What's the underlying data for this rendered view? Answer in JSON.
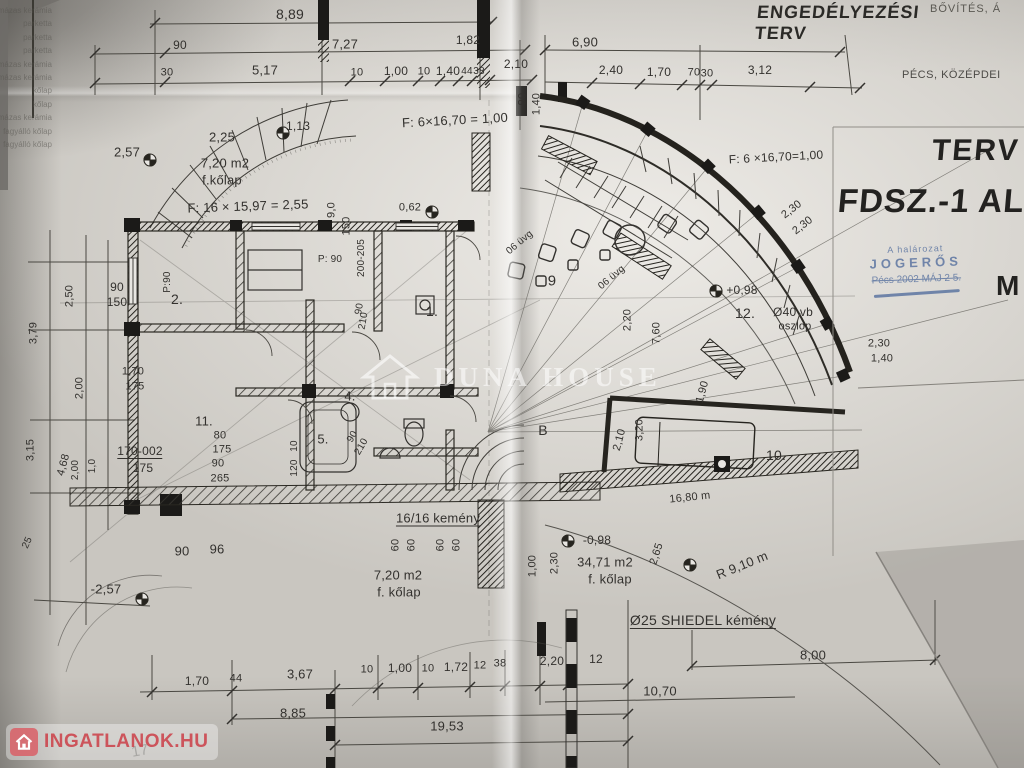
{
  "titles": {
    "plan_type": "ENGEDÉLYEZÉSI\nTERV",
    "top_right_note": "BŐVÍTÉS, Á",
    "location_note": "PÉCS, KÖZÉPDEI",
    "sheet_title_top": "TERV",
    "sheet_title_main": "FDSZ.-1 ALA",
    "scale_letter": "M"
  },
  "stamp": {
    "line1": "A halározat",
    "line2": "JOGERŐS",
    "line3": "Pécs 2002 MÁJ 2 5."
  },
  "watermark_center": {
    "text": "DUNA HOUSE"
  },
  "watermark_corner": {
    "text": "INGATLANOK.HU"
  },
  "legend_column": [
    "mázas kerámia",
    "parketta",
    "parketta",
    "parketta",
    "mázas kerámia",
    "mázas kerámia",
    "kőlap",
    "kőlap",
    "mázas kerámia",
    "fagyálló kőlap",
    "fagyálló kőlap"
  ],
  "colors": {
    "paper": "#c9c6c0",
    "ink": "#33312e",
    "stamp_blue": "#6179a3",
    "watermark_red": "#cb3e46",
    "watermark_white": "rgba(255,255,255,0.55)"
  },
  "annotations": [
    {
      "t": "8,89",
      "x": 290,
      "y": 14,
      "s": 14
    },
    {
      "t": "90",
      "x": 180,
      "y": 45,
      "s": 12
    },
    {
      "t": "7,27",
      "x": 345,
      "y": 44,
      "s": 13
    },
    {
      "t": "1,82",
      "x": 468,
      "y": 40,
      "s": 12
    },
    {
      "t": "6,90",
      "x": 585,
      "y": 42,
      "s": 13
    },
    {
      "t": "30",
      "x": 167,
      "y": 73,
      "s": 11
    },
    {
      "t": "5,17",
      "x": 265,
      "y": 70,
      "s": 13
    },
    {
      "t": "10",
      "x": 357,
      "y": 73,
      "s": 11
    },
    {
      "t": "1,00",
      "x": 396,
      "y": 71,
      "s": 12
    },
    {
      "t": "10",
      "x": 424,
      "y": 72,
      "s": 11
    },
    {
      "t": "1,40",
      "x": 448,
      "y": 71,
      "s": 12
    },
    {
      "t": "44",
      "x": 467,
      "y": 72,
      "s": 10
    },
    {
      "t": "38",
      "x": 479,
      "y": 72,
      "s": 10
    },
    {
      "t": "2,10",
      "x": 516,
      "y": 64,
      "s": 12
    },
    {
      "t": "2,40",
      "x": 611,
      "y": 70,
      "s": 12
    },
    {
      "t": "1,70",
      "x": 659,
      "y": 72,
      "s": 12
    },
    {
      "t": "70",
      "x": 694,
      "y": 73,
      "s": 11
    },
    {
      "t": "30",
      "x": 707,
      "y": 74,
      "s": 11
    },
    {
      "t": "3,12",
      "x": 760,
      "y": 70,
      "s": 12
    },
    {
      "t": "90",
      "x": 523,
      "y": 99,
      "s": 11,
      "r": -90
    },
    {
      "t": "1,40",
      "x": 537,
      "y": 104,
      "s": 11,
      "r": -90
    },
    {
      "t": "F: 6×16,70 = 1,00",
      "x": 455,
      "y": 120,
      "s": 13,
      "r": -3
    },
    {
      "t": "-1,13",
      "x": 296,
      "y": 126,
      "s": 12
    },
    {
      "t": "2,25",
      "x": 222,
      "y": 137,
      "s": 13
    },
    {
      "t": "2,57",
      "x": 127,
      "y": 152,
      "s": 13
    },
    {
      "t": "7,20 m2",
      "x": 225,
      "y": 163,
      "s": 13
    },
    {
      "t": "f.kőlap",
      "x": 222,
      "y": 180,
      "s": 13
    },
    {
      "t": "F: 16 × 15,97 = 2,55",
      "x": 248,
      "y": 206,
      "s": 13,
      "r": -2
    },
    {
      "t": "F: 6 ×16,70=1,00",
      "x": 776,
      "y": 157,
      "s": 12,
      "r": -3
    },
    {
      "t": "2,30",
      "x": 792,
      "y": 210,
      "s": 11,
      "r": -38
    },
    {
      "t": "2,30",
      "x": 803,
      "y": 226,
      "s": 11,
      "r": -38
    },
    {
      "t": "06 üvg",
      "x": 520,
      "y": 243,
      "s": 10,
      "r": -40
    },
    {
      "t": "06 üvg",
      "x": 612,
      "y": 278,
      "s": 10,
      "r": -40
    },
    {
      "t": "9",
      "x": 552,
      "y": 281,
      "s": 15
    },
    {
      "t": "+0,98",
      "x": 742,
      "y": 290,
      "s": 12
    },
    {
      "t": "12.",
      "x": 745,
      "y": 313,
      "s": 14
    },
    {
      "t": "Ø40 vb",
      "x": 793,
      "y": 312,
      "s": 12
    },
    {
      "t": "oszlop",
      "x": 795,
      "y": 327,
      "s": 11
    },
    {
      "t": "2,30",
      "x": 879,
      "y": 344,
      "s": 11
    },
    {
      "t": "1,40",
      "x": 882,
      "y": 359,
      "s": 11
    },
    {
      "t": "2,20",
      "x": 628,
      "y": 320,
      "s": 11,
      "r": -90
    },
    {
      "t": "7,60",
      "x": 657,
      "y": 333,
      "s": 11,
      "r": -90
    },
    {
      "t": "1,90",
      "x": 703,
      "y": 392,
      "s": 11,
      "r": -75
    },
    {
      "t": "3,20",
      "x": 640,
      "y": 430,
      "s": 11,
      "r": -90
    },
    {
      "t": "2,10",
      "x": 620,
      "y": 440,
      "s": 11,
      "r": -75
    },
    {
      "t": "10.",
      "x": 776,
      "y": 455,
      "s": 14
    },
    {
      "t": "B",
      "x": 543,
      "y": 430,
      "s": 14
    },
    {
      "t": "90",
      "x": 117,
      "y": 287,
      "s": 12
    },
    {
      "t": "150",
      "x": 117,
      "y": 302,
      "s": 12
    },
    {
      "t": "2,50",
      "x": 70,
      "y": 296,
      "s": 11,
      "r": -90
    },
    {
      "t": "3,79",
      "x": 34,
      "y": 333,
      "s": 11,
      "r": -90
    },
    {
      "t": "9,0",
      "x": 332,
      "y": 210,
      "s": 11,
      "r": -90
    },
    {
      "t": "150",
      "x": 347,
      "y": 226,
      "s": 11,
      "r": -90
    },
    {
      "t": "200-205",
      "x": 362,
      "y": 258,
      "s": 10,
      "r": -90
    },
    {
      "t": "0,62",
      "x": 410,
      "y": 208,
      "s": 11
    },
    {
      "t": "P: 90",
      "x": 330,
      "y": 260,
      "s": 10
    },
    {
      "t": "P:90",
      "x": 168,
      "y": 282,
      "s": 10,
      "r": -90
    },
    {
      "t": "2.",
      "x": 177,
      "y": 299,
      "s": 14
    },
    {
      "t": "1.",
      "x": 432,
      "y": 311,
      "s": 14
    },
    {
      "t": "90",
      "x": 360,
      "y": 309,
      "s": 10,
      "r": -80
    },
    {
      "t": "210",
      "x": 364,
      "y": 321,
      "s": 10,
      "r": -80
    },
    {
      "t": "1,70",
      "x": 133,
      "y": 372,
      "s": 11
    },
    {
      "t": "175",
      "x": 135,
      "y": 387,
      "s": 11
    },
    {
      "t": "2,00",
      "x": 80,
      "y": 388,
      "s": 11,
      "r": -90
    },
    {
      "t": "11.",
      "x": 204,
      "y": 421,
      "s": 13
    },
    {
      "t": "80",
      "x": 220,
      "y": 436,
      "s": 11
    },
    {
      "t": "175",
      "x": 222,
      "y": 450,
      "s": 11
    },
    {
      "t": "90",
      "x": 218,
      "y": 464,
      "s": 11
    },
    {
      "t": "265",
      "x": 220,
      "y": 479,
      "s": 11
    },
    {
      "t": "10",
      "x": 295,
      "y": 446,
      "s": 10,
      "r": -90
    },
    {
      "t": "120",
      "x": 295,
      "y": 468,
      "s": 10,
      "r": -90
    },
    {
      "t": "5.",
      "x": 323,
      "y": 439,
      "s": 13
    },
    {
      "t": "4.",
      "x": 350,
      "y": 396,
      "s": 13
    },
    {
      "t": "90",
      "x": 353,
      "y": 437,
      "s": 10,
      "r": -60
    },
    {
      "t": "210",
      "x": 362,
      "y": 447,
      "s": 10,
      "r": -60
    },
    {
      "t": "170-002",
      "x": 140,
      "y": 452,
      "s": 12,
      "c": "u"
    },
    {
      "t": "175",
      "x": 143,
      "y": 468,
      "s": 12
    },
    {
      "t": "3,15",
      "x": 31,
      "y": 450,
      "s": 11,
      "r": -90
    },
    {
      "t": "4,68",
      "x": 64,
      "y": 465,
      "s": 11,
      "r": -75
    },
    {
      "t": "2,00",
      "x": 76,
      "y": 470,
      "s": 10,
      "r": -90
    },
    {
      "t": "1,0",
      "x": 93,
      "y": 466,
      "s": 10,
      "r": -90
    },
    {
      "t": "25",
      "x": 28,
      "y": 543,
      "s": 10,
      "r": -65
    },
    {
      "t": "90",
      "x": 182,
      "y": 551,
      "s": 13
    },
    {
      "t": "96",
      "x": 217,
      "y": 549,
      "s": 13
    },
    {
      "t": "-2,57",
      "x": 106,
      "y": 589,
      "s": 13
    },
    {
      "t": "16/16 kemény",
      "x": 438,
      "y": 519,
      "s": 13,
      "c": "u"
    },
    {
      "t": "60",
      "x": 396,
      "y": 545,
      "s": 11,
      "r": -90
    },
    {
      "t": "60",
      "x": 412,
      "y": 545,
      "s": 11,
      "r": -90
    },
    {
      "t": "60",
      "x": 441,
      "y": 545,
      "s": 11,
      "r": -90
    },
    {
      "t": "60",
      "x": 457,
      "y": 545,
      "s": 11,
      "r": -90
    },
    {
      "t": "7,20 m2",
      "x": 398,
      "y": 575,
      "s": 13
    },
    {
      "t": "f. kőlap",
      "x": 399,
      "y": 592,
      "s": 13
    },
    {
      "t": "-0,98",
      "x": 597,
      "y": 540,
      "s": 12
    },
    {
      "t": "1,00",
      "x": 533,
      "y": 566,
      "s": 11,
      "r": -90
    },
    {
      "t": "2,30",
      "x": 555,
      "y": 563,
      "s": 11,
      "r": -90
    },
    {
      "t": "34,71 m2",
      "x": 605,
      "y": 562,
      "s": 13
    },
    {
      "t": "f. kőlap",
      "x": 610,
      "y": 579,
      "s": 13
    },
    {
      "t": "2,65",
      "x": 657,
      "y": 554,
      "s": 11,
      "r": -72
    },
    {
      "t": "R 9,10 m",
      "x": 742,
      "y": 565,
      "s": 13,
      "r": -22
    },
    {
      "t": "16,80 m",
      "x": 690,
      "y": 498,
      "s": 11,
      "r": -6
    },
    {
      "t": "Ø25  SHIEDEL kémény",
      "x": 703,
      "y": 621,
      "s": 14,
      "c": "u"
    },
    {
      "t": "8,00",
      "x": 813,
      "y": 655,
      "s": 13
    },
    {
      "t": "10,70",
      "x": 660,
      "y": 691,
      "s": 13
    },
    {
      "t": "2,20",
      "x": 552,
      "y": 661,
      "s": 12
    },
    {
      "t": "12",
      "x": 596,
      "y": 659,
      "s": 12
    },
    {
      "t": "1,70",
      "x": 197,
      "y": 681,
      "s": 12
    },
    {
      "t": "44",
      "x": 236,
      "y": 679,
      "s": 11
    },
    {
      "t": "3,67",
      "x": 300,
      "y": 674,
      "s": 13
    },
    {
      "t": "10",
      "x": 367,
      "y": 670,
      "s": 11
    },
    {
      "t": "1,00",
      "x": 400,
      "y": 668,
      "s": 12
    },
    {
      "t": "10",
      "x": 428,
      "y": 669,
      "s": 11
    },
    {
      "t": "1,72",
      "x": 456,
      "y": 667,
      "s": 12
    },
    {
      "t": "12",
      "x": 480,
      "y": 666,
      "s": 11
    },
    {
      "t": "38",
      "x": 500,
      "y": 664,
      "s": 11
    },
    {
      "t": "8,85",
      "x": 293,
      "y": 713,
      "s": 13
    },
    {
      "t": "19,53",
      "x": 447,
      "y": 726,
      "s": 13
    },
    {
      "t": "17",
      "x": 140,
      "y": 751,
      "s": 15,
      "r": -10,
      "c": "pencil"
    }
  ]
}
